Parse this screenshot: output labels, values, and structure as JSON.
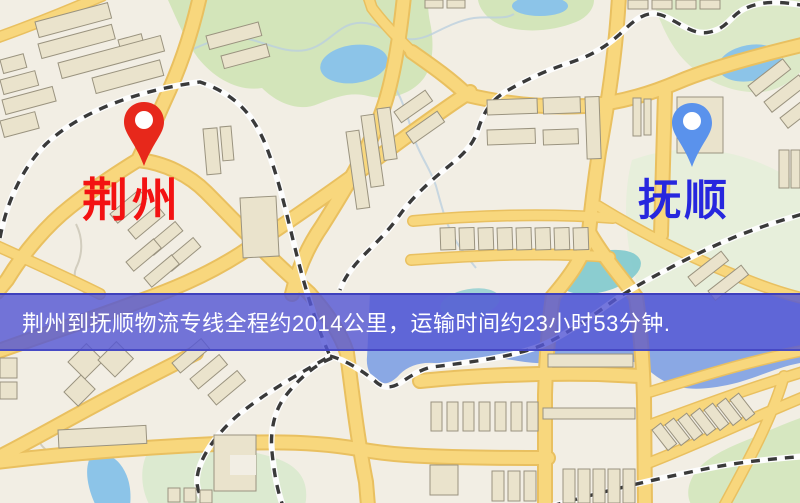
{
  "banner": {
    "text": "荆州到抚顺物流专线全程约2014公里，运输时间约23小时53分钟.",
    "background_color": "#5658d4",
    "text_color": "#ffffff"
  },
  "origin": {
    "label": "荆州",
    "label_color": "#f31212",
    "pin_color": "#e7281b",
    "pin_icon": "red-map-pin"
  },
  "destination": {
    "label": "抚顺",
    "label_color": "#2727de",
    "pin_color": "#5a92ec",
    "pin_icon": "blue-map-pin"
  },
  "map_colors": {
    "land": "#f2eee4",
    "road_fill": "#f8d77d",
    "road_casing": "#e9c060",
    "building_fill": "#eae3cc",
    "building_outline": "#9a937f",
    "park": "#d3e5ba",
    "park_pale": "#e7efdb",
    "water": "#8aa8e4",
    "pond": "#8cc4e8",
    "teal_water": "#7fc9cd",
    "railway": "#3a3a3a"
  }
}
